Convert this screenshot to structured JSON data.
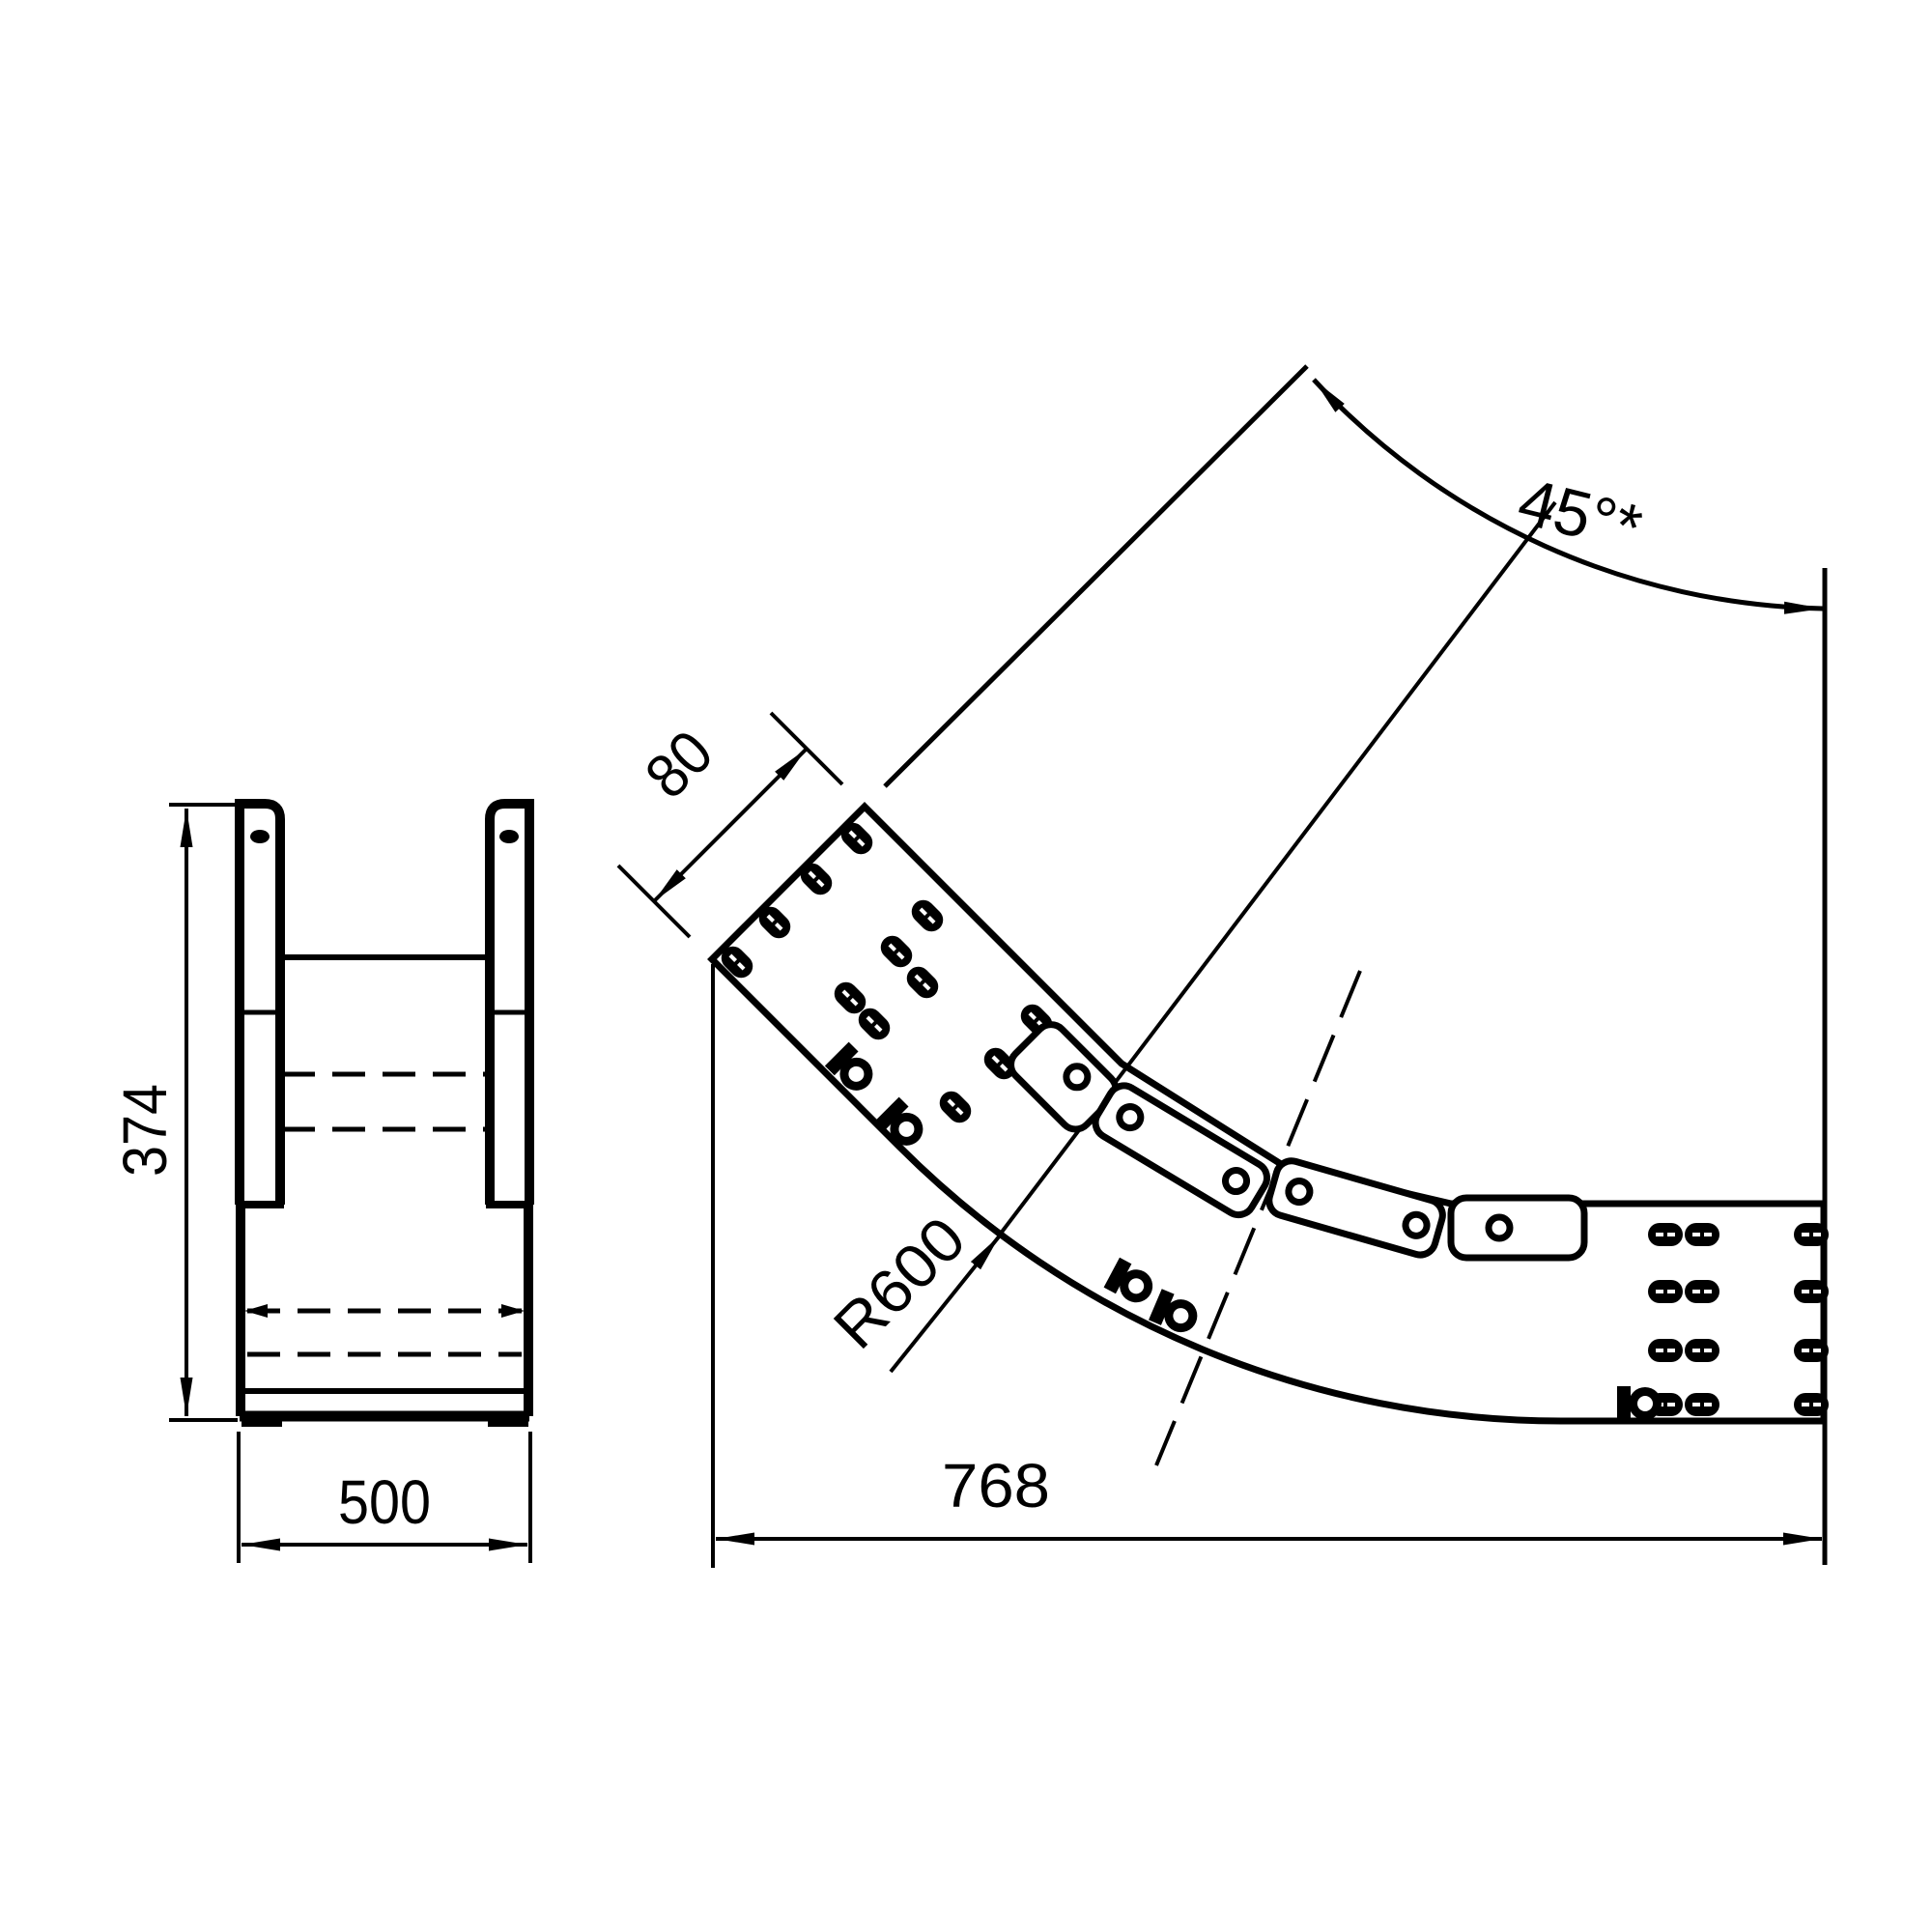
{
  "drawing": {
    "type": "technical-drawing",
    "description": "cable tray 45 degree riser bend, two orthographic views",
    "line_color": "#000000",
    "background": "#ffffff",
    "labels": {
      "height": "374",
      "width": "500",
      "rail": "80",
      "radius": "R600",
      "angle": "45°*",
      "length": "768"
    }
  }
}
